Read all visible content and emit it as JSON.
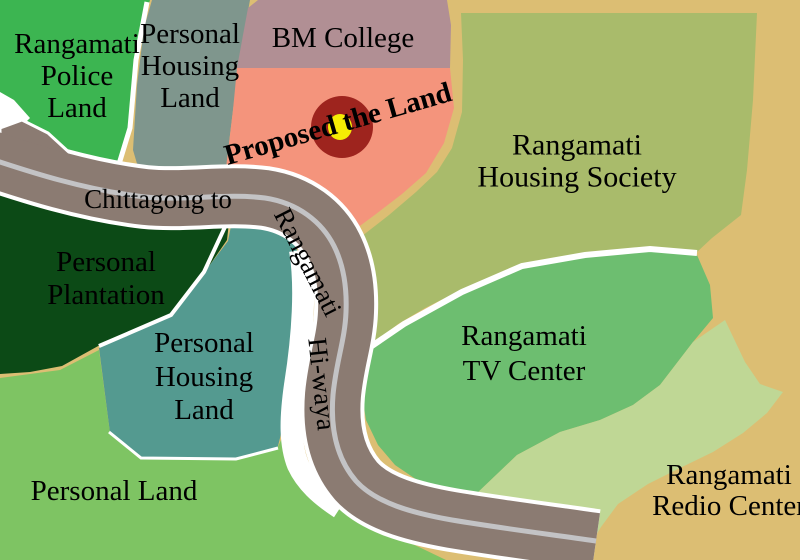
{
  "map": {
    "background_color": "#dcbe73",
    "divider_color": "#ffffff",
    "text_color": "#000000",
    "regions": [
      {
        "name": "Rangamati Police Land",
        "color": "#3cb551",
        "lines": [
          "Rangamati",
          "Police",
          "Land"
        ]
      },
      {
        "name": "Personal Housing Land (north)",
        "color": "#7f968d",
        "lines": [
          "Personal",
          "Housing",
          "Land"
        ]
      },
      {
        "name": "BM College",
        "color": "#b18f94",
        "lines": [
          "BM College"
        ]
      },
      {
        "name": "Proposed the Land",
        "color": "#f4947c",
        "lines": [
          "Proposed the Land"
        ]
      },
      {
        "name": "Rangamati Housing Society",
        "color": "#a9bb6b",
        "lines": [
          "Rangamati",
          "Housing Society"
        ]
      },
      {
        "name": "Personal Plantation",
        "color": "#0c4a16",
        "lines": [
          "Personal",
          "Plantation"
        ]
      },
      {
        "name": "Personal Housing Land (central)",
        "color": "#549a90",
        "lines": [
          "Personal",
          "Housing",
          "Land"
        ]
      },
      {
        "name": "Rangamati TV Center",
        "color": "#6dbe70",
        "lines": [
          "Rangamati",
          "TV Center"
        ]
      },
      {
        "name": "Personal Land",
        "color": "#7ec463",
        "lines": [
          "Personal Land"
        ]
      },
      {
        "name": "Rangamati Redio Center",
        "color": "#dcbe73",
        "lines": [
          "Rangamati",
          "Redio Center"
        ]
      },
      {
        "name": "Green strip (unlabeled)",
        "color": "#bfd795",
        "lines": []
      }
    ],
    "road": {
      "color": "#8b7b72",
      "casing_color": "#ffffff",
      "centerline_color": "#c3c3c5",
      "labels": {
        "part1": "Chittagong to",
        "part2": "Rangamati",
        "part3": "Hi-waya"
      }
    },
    "marker": {
      "outer_color": "#9e241e",
      "inner_color": "#f5ec04"
    }
  }
}
